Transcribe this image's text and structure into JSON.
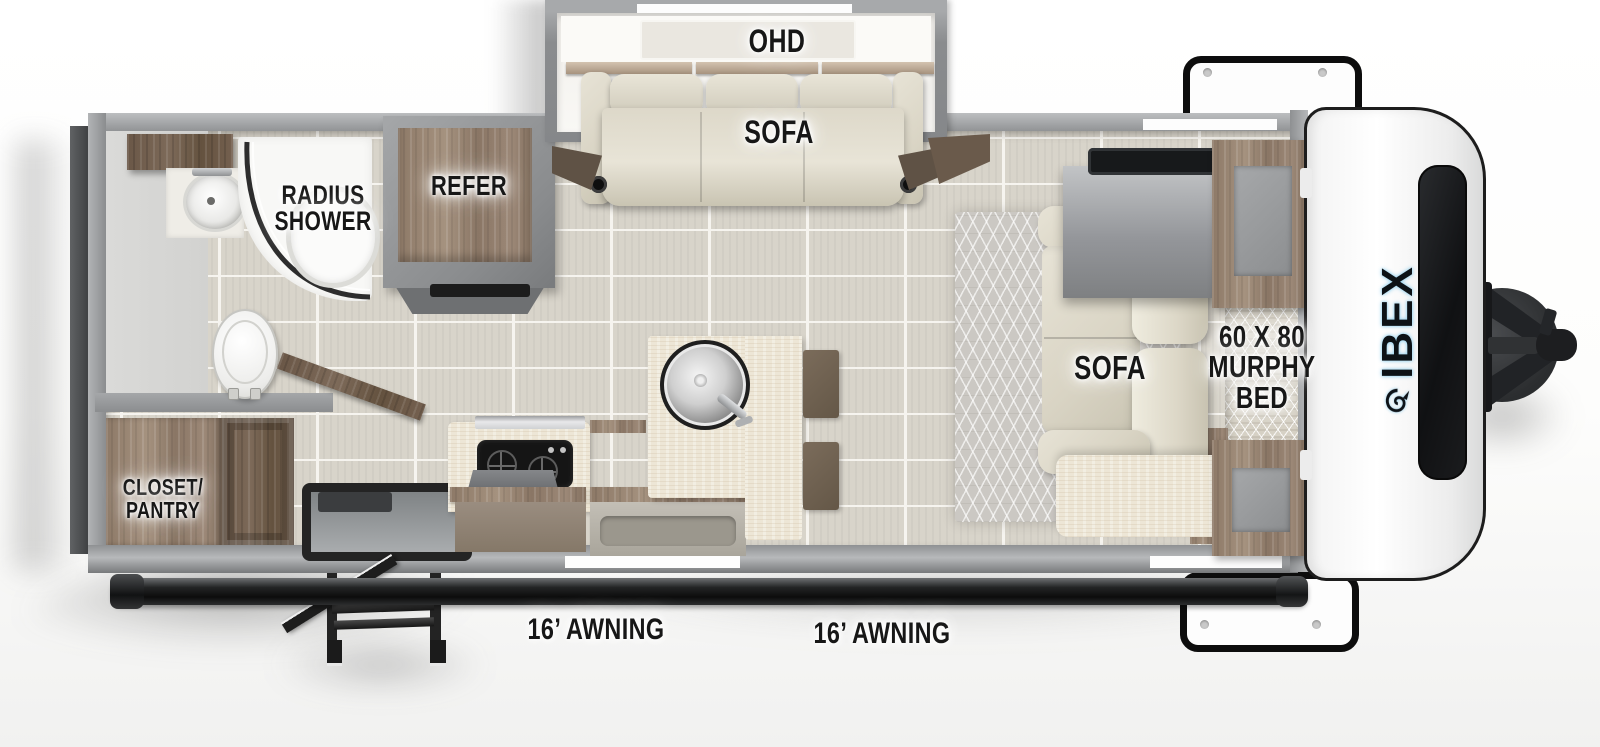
{
  "brand": {
    "name": "IBEX"
  },
  "labels": {
    "ohd": "OHD",
    "slide_sofa": "SOFA",
    "radius_shower": "RADIUS\nSHOWER",
    "refer": "REFER",
    "closet_pantry": "CLOSET/\nPANTRY",
    "main_sofa": "SOFA",
    "murphy_bed": "60 X 80\nMURPHY\nBED",
    "awning_left": "16’ AWNING",
    "awning_right": "16’ AWNING"
  },
  "icons": {
    "toilet": "toilet-icon",
    "bathroom_sink": "sink-icon",
    "kitchen_sink": "round-sink-icon",
    "stove": "stove-icon",
    "shower": "radius-shower-icon",
    "tv": "tv-icon",
    "hitch": "trailer-hitch-icon",
    "steps": "entry-steps-icon",
    "ram_logo": "ibex-ram-icon"
  },
  "colors": {
    "wall_gray": "#97999b",
    "floor_tile": "#d8d4ca",
    "wood": "#95816f",
    "travertine": "#ede6d6",
    "label_text": "#171717",
    "logo_glow_blue": "#8ccceb",
    "cap_white": "#ffffff",
    "hitch_black": "#1d1f21"
  }
}
